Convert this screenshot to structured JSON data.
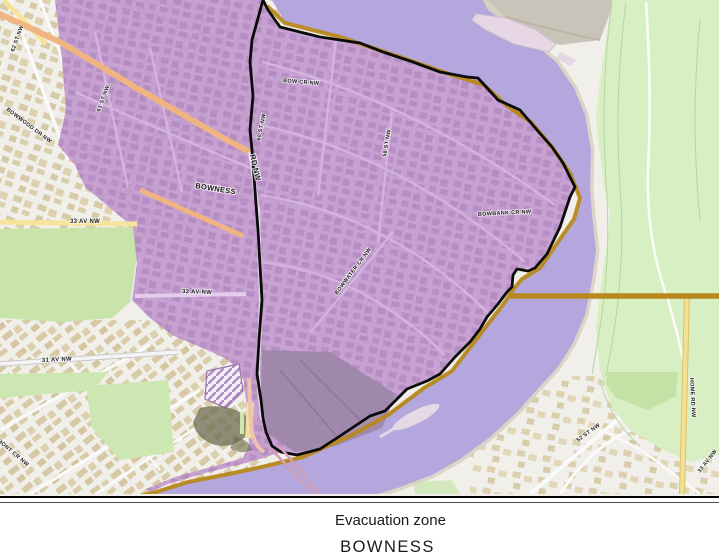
{
  "caption": {
    "line1": "Evacuation zone",
    "line2": "BOWNESS"
  },
  "map": {
    "street_labels": [
      "62 ST NW",
      "61 ST NW",
      "BOWWOOD DR NW",
      "BOWNESS",
      "RD NW",
      "BOW CR NW",
      "60 ST NW",
      "58 ST NW",
      "BOWBANK CR NW",
      "BOWWATER CR NW",
      "33 AV NW",
      "32 AV NW",
      "31 AV NW",
      "BOWMONT CR NW",
      "52 ST NW",
      "HOME RD NW",
      "33 AV NW"
    ]
  },
  "colors": {
    "urban_base": "#f1efe9",
    "evacuation_zone_fill": "#c29ace",
    "zone_boundary": "#0b0b0b",
    "river": "#b3a7de",
    "park_green": "#d8eec3",
    "berm_line": "#b8881c"
  }
}
